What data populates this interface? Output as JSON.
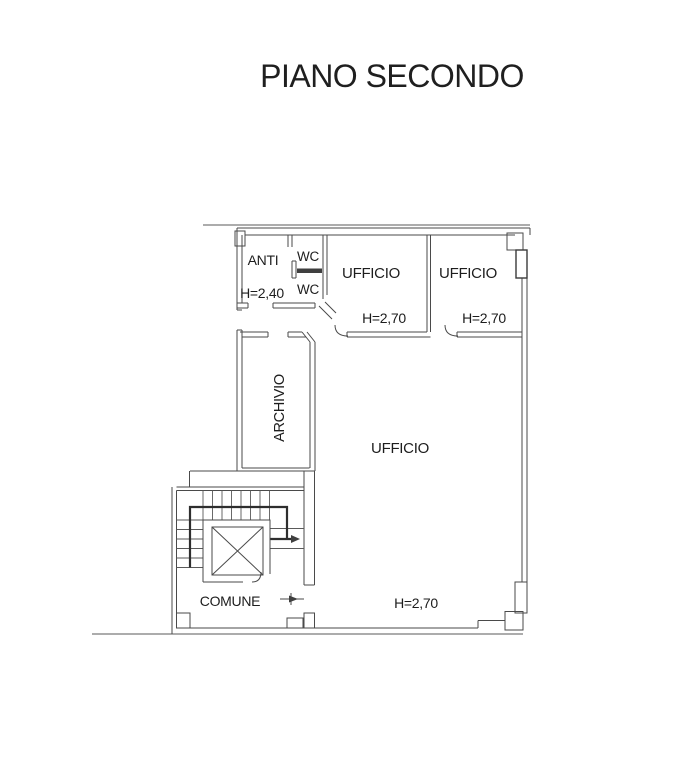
{
  "title": "PIANO SECONDO",
  "plan": {
    "rooms": {
      "anti": {
        "name": "ANTI",
        "height": "H=2,40"
      },
      "wc_upper": {
        "name": "WC"
      },
      "wc_lower": {
        "name": "WC"
      },
      "ufficio_left": {
        "name": "UFFICIO",
        "height": "H=2,70"
      },
      "ufficio_right": {
        "name": "UFFICIO",
        "height": "H=2,70"
      },
      "archivio": {
        "name": "ARCHIVIO"
      },
      "ufficio_main": {
        "name": "UFFICIO",
        "height": "H=2,70"
      },
      "comune": {
        "name": "COMUNE"
      }
    },
    "colors": {
      "wall_line": "#4a4a4a",
      "dark_line": "#2e2e2e",
      "text": "#1d1d1d",
      "background": "#ffffff"
    }
  }
}
